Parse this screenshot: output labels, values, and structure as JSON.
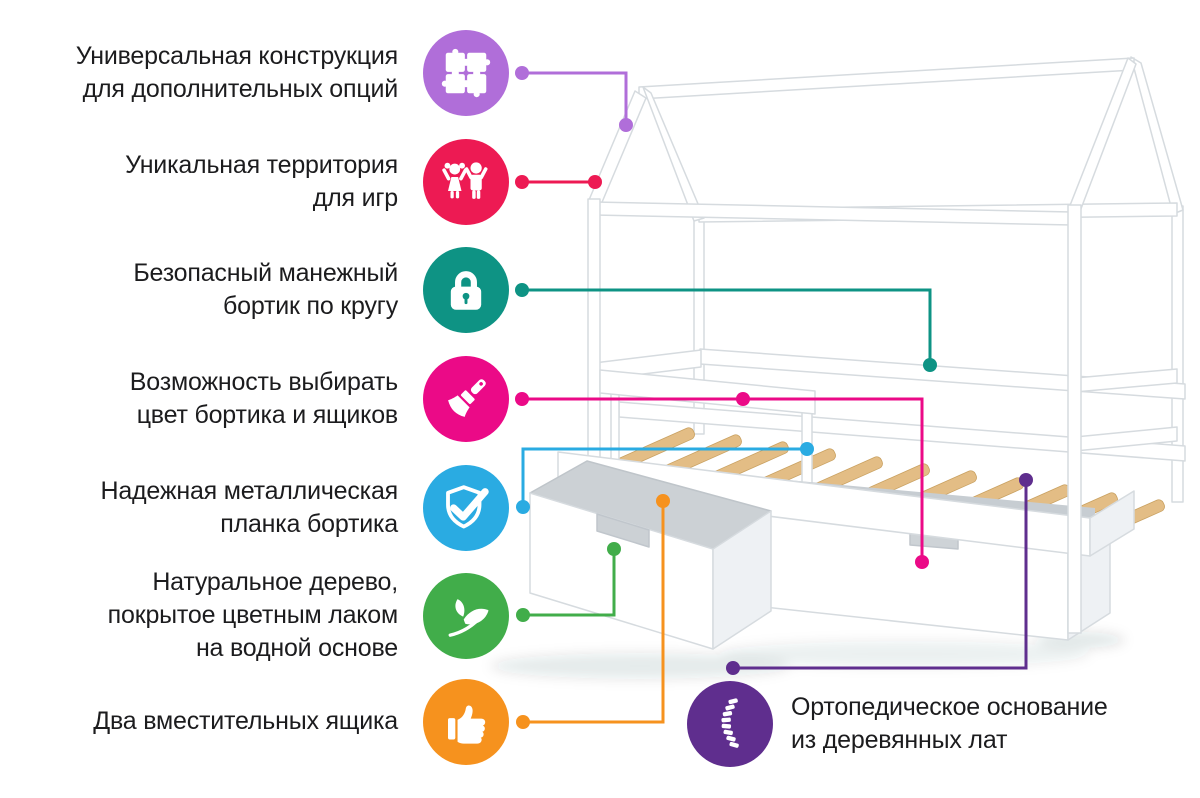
{
  "features": [
    {
      "id": "universal-construction",
      "label_lines": [
        "Универсальная конструкция",
        "для дополнительных опций"
      ],
      "icon": "puzzle-icon",
      "color": "#b06ed9"
    },
    {
      "id": "play-territory",
      "label_lines": [
        "Уникальная территория",
        "для игр"
      ],
      "icon": "children-icon",
      "color": "#ed1a53"
    },
    {
      "id": "safe-playpen-rail",
      "label_lines": [
        "Безопасный манежный",
        "бортик по кругу"
      ],
      "icon": "lock-icon",
      "color": "#0e9384"
    },
    {
      "id": "color-choice",
      "label_lines": [
        "Возможность выбирать",
        "цвет бортика и ящиков"
      ],
      "icon": "paintbrush-icon",
      "color": "#eb0a87"
    },
    {
      "id": "metal-plank",
      "label_lines": [
        "Надежная металлическая",
        "планка бортика"
      ],
      "icon": "shield-check-icon",
      "color": "#2aabe2"
    },
    {
      "id": "natural-wood",
      "label_lines": [
        "Натуральное дерево,",
        "покрытое цветным лаком",
        "на водной основе"
      ],
      "icon": "leaf-icon",
      "color": "#41ad4a"
    },
    {
      "id": "two-drawers",
      "label_lines": [
        "Два вместительных ящика"
      ],
      "icon": "thumbs-up-icon",
      "color": "#f6921e"
    },
    {
      "id": "orthopedic-base",
      "label_lines": [
        "Ортопедическое основание",
        "из деревянных лат"
      ],
      "icon": "spine-icon",
      "color": "#5f2e8e"
    }
  ]
}
